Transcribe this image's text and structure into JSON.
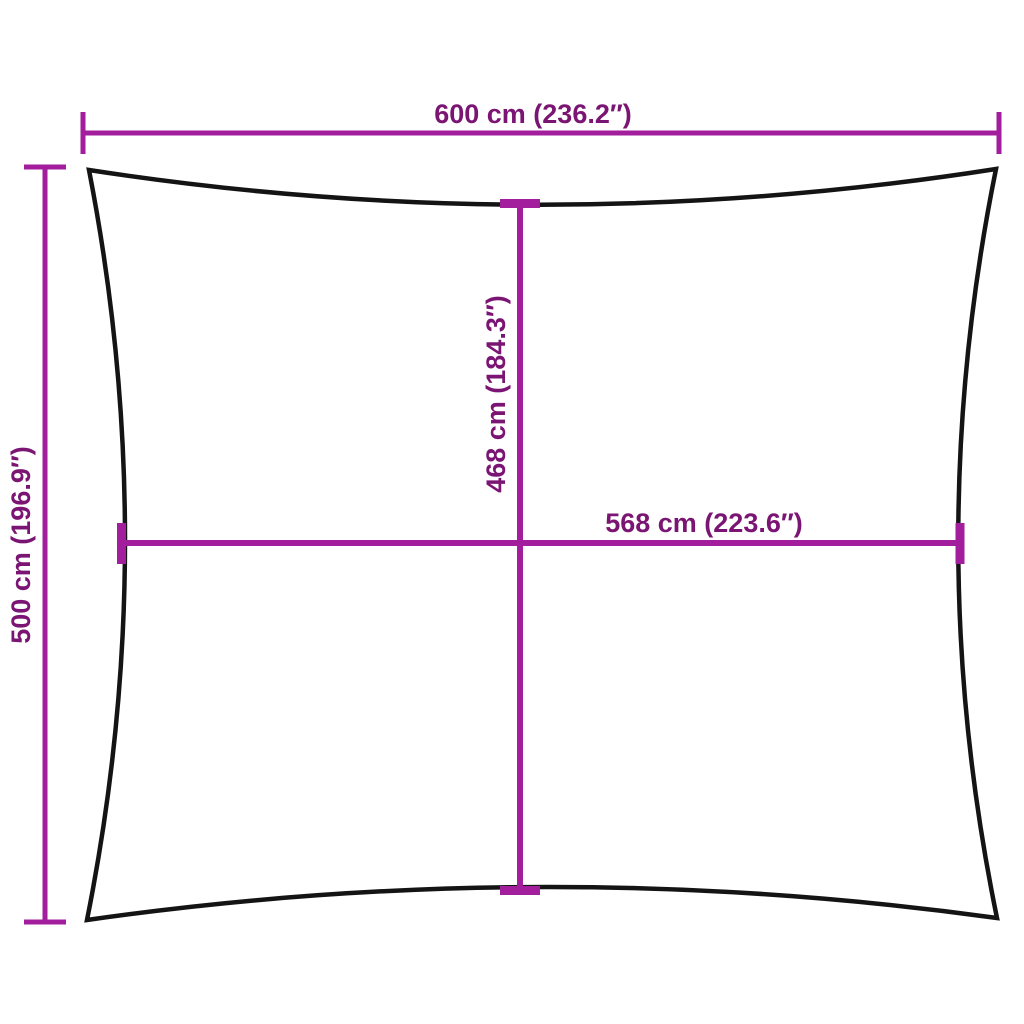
{
  "diagram": {
    "title": "shade-sail-dimension-diagram",
    "shape": "rectangle-concave-edges",
    "colors": {
      "dimension_line": "#A21E9C",
      "dimension_text": "#7B1573",
      "outline": "#141414",
      "background": "#ffffff"
    },
    "dimensions": [
      {
        "id": "outer-width",
        "position": "top",
        "value": 600,
        "unit": "cm",
        "inches": "236.2",
        "label": "600 cm (236.2″)"
      },
      {
        "id": "outer-height",
        "position": "left",
        "value": 500,
        "unit": "cm",
        "inches": "196.9",
        "label": "500 cm (196.9″)"
      },
      {
        "id": "inner-height",
        "position": "center-vertical",
        "value": 468,
        "unit": "cm",
        "inches": "184.3",
        "label": "468 cm (184.3″)"
      },
      {
        "id": "inner-width",
        "position": "center-horizontal",
        "value": 568,
        "unit": "cm",
        "inches": "223.6",
        "label": "568 cm (223.6″)"
      }
    ]
  }
}
